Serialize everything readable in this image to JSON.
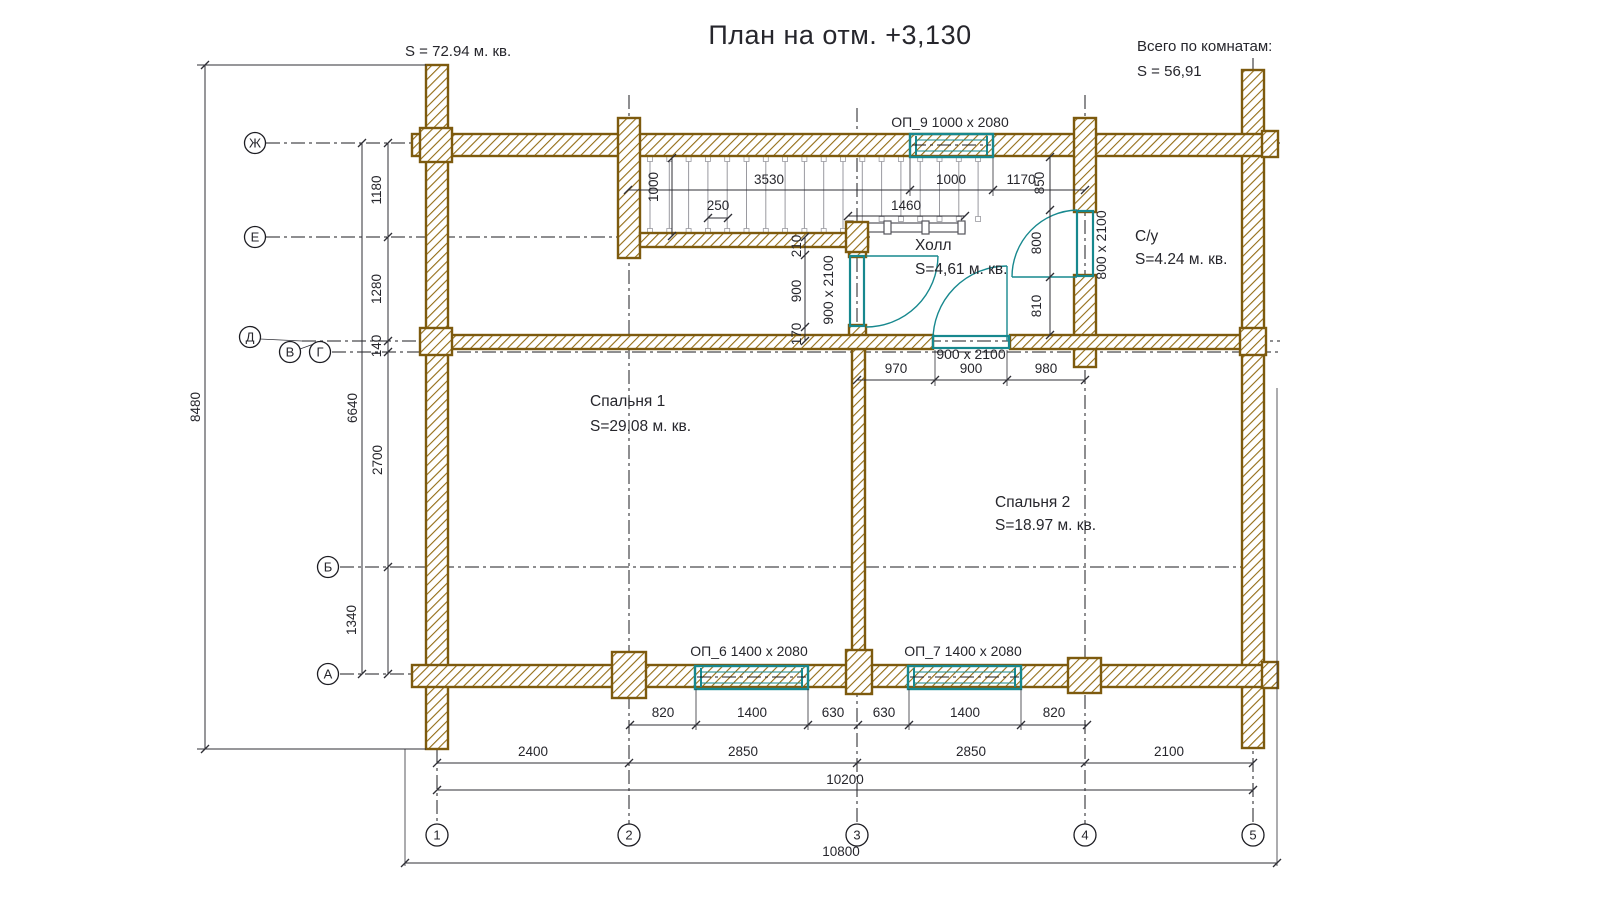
{
  "title": "План на отм. +3,130",
  "summary": {
    "left_area": "S  =  72.94 м. кв.",
    "right_heading": "Всего по комнатам:",
    "right_area": "S    =  56,91"
  },
  "rooms": [
    {
      "name": "Спальня 1",
      "area": "S=29.08 м. кв."
    },
    {
      "name": "Спальня 2",
      "area": "S=18.97 м. кв."
    },
    {
      "name": "Холл",
      "area": "S=4,61 м. кв."
    },
    {
      "name": "С/у",
      "area": "S=4.24 м. кв."
    }
  ],
  "windows": [
    "ОП_9 1000 x 2080",
    "ОП_6 1400 x 2080",
    "ОП_7 1400 x 2080"
  ],
  "doors": [
    "900 х 2100",
    "900 x 2100",
    "800 x 2100"
  ],
  "axes": {
    "h": [
      "Ж",
      "Е",
      "Д",
      "В",
      "Г",
      "Б",
      "А"
    ],
    "v": [
      "1",
      "2",
      "3",
      "4",
      "5"
    ]
  },
  "dims": {
    "overall_left": "8480",
    "total_left": "6640",
    "left_chain": [
      "1180",
      "1280",
      "140",
      "2700",
      "1340"
    ],
    "stair_width": "1000",
    "tread": "250",
    "top_chain": [
      "3530",
      "1000",
      "1170"
    ],
    "landing": "1460",
    "hall_left_chain": [
      "210",
      "900",
      "170"
    ],
    "su_chain": [
      "850",
      "800",
      "810"
    ],
    "hall_bottom_chain": [
      "970",
      "900",
      "980"
    ],
    "window_chain": [
      "820",
      "1400",
      "630",
      "630",
      "1400",
      "820"
    ],
    "axis_chain": [
      "2400",
      "2850",
      "2850",
      "2100"
    ],
    "total_bottom": "10200",
    "overall_bottom": "10800"
  },
  "colors": {
    "wall_brown": "#7d5a0e",
    "hatch_brown": "#936c14",
    "accent_teal": "#17888e",
    "line_dark": "#2f2f36"
  }
}
